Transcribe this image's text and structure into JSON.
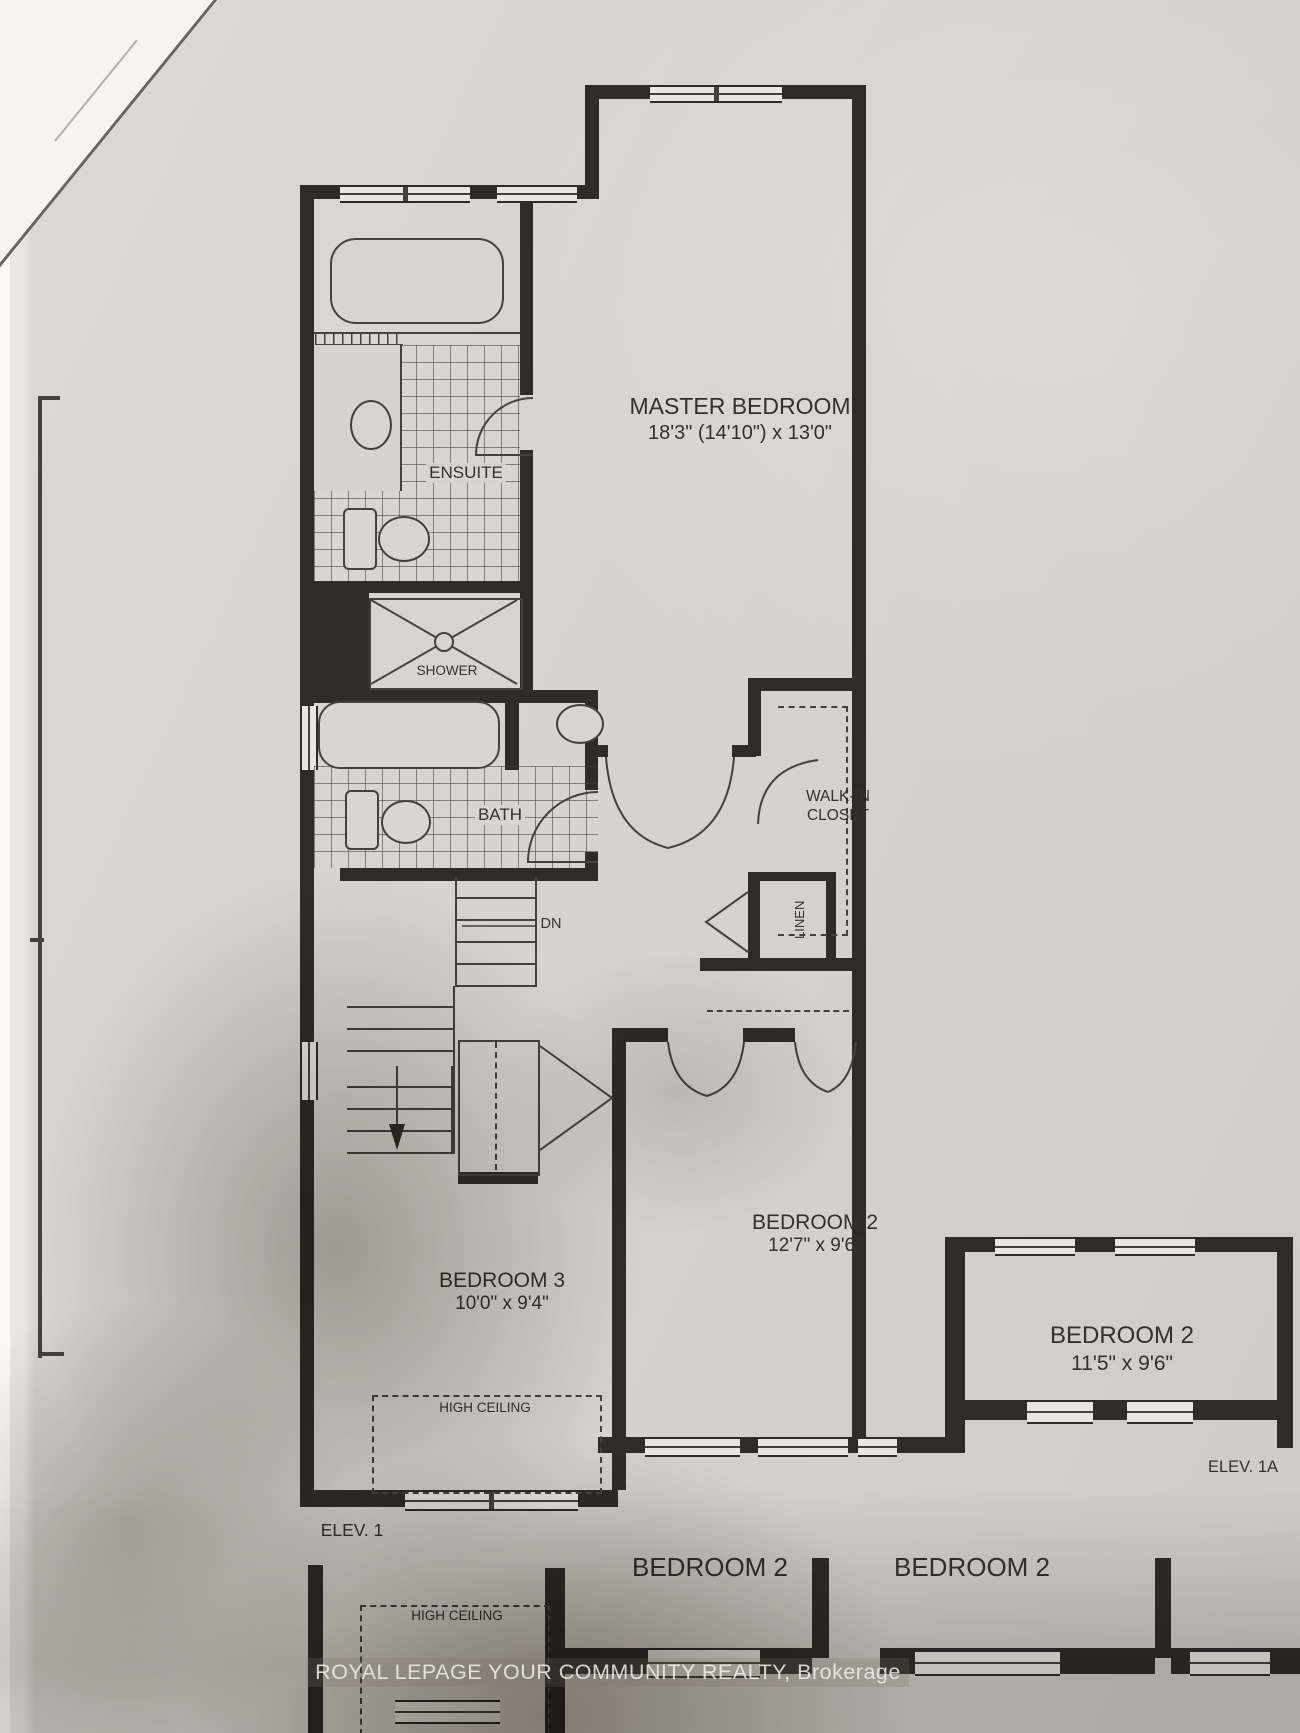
{
  "colors": {
    "paper": "#d7d3ce",
    "wall": "#2e2b28",
    "line": "#45413c",
    "watermark_text": "#f2f0ec"
  },
  "rooms": {
    "master_bedroom": {
      "name": "MASTER BEDROOM",
      "dimensions": "18'3\" (14'10\") x 13'0\""
    },
    "ensuite": {
      "name": "ENSUITE"
    },
    "shower": {
      "name": "SHOWER"
    },
    "bath": {
      "name": "BATH"
    },
    "walk_in_closet": {
      "line1": "WALK-IN",
      "line2": "CLOSET"
    },
    "linen": {
      "name": "LINEN"
    },
    "bedroom_2": {
      "name": "BEDROOM 2",
      "dimensions": "12'7\" x 9'6\""
    },
    "bedroom_3": {
      "name": "BEDROOM 3",
      "dimensions": "10'0\" x 9'4\""
    },
    "bedroom_2_alt": {
      "name": "BEDROOM 2",
      "dimensions": "11'5\" x 9'6\""
    },
    "bedroom_2_bottom_left": {
      "name": "BEDROOM 2"
    },
    "bedroom_2_bottom_right": {
      "name": "BEDROOM 2"
    }
  },
  "annotations": {
    "stairs_direction": "DN",
    "high_ceiling_main": "HIGH CEILING",
    "high_ceiling_bottom": "HIGH CEILING",
    "elevation_1": "ELEV. 1",
    "elevation_1a": "ELEV. 1A"
  },
  "watermark": {
    "text": "ROYAL LEPAGE YOUR COMMUNITY REALTY, Brokerage"
  }
}
